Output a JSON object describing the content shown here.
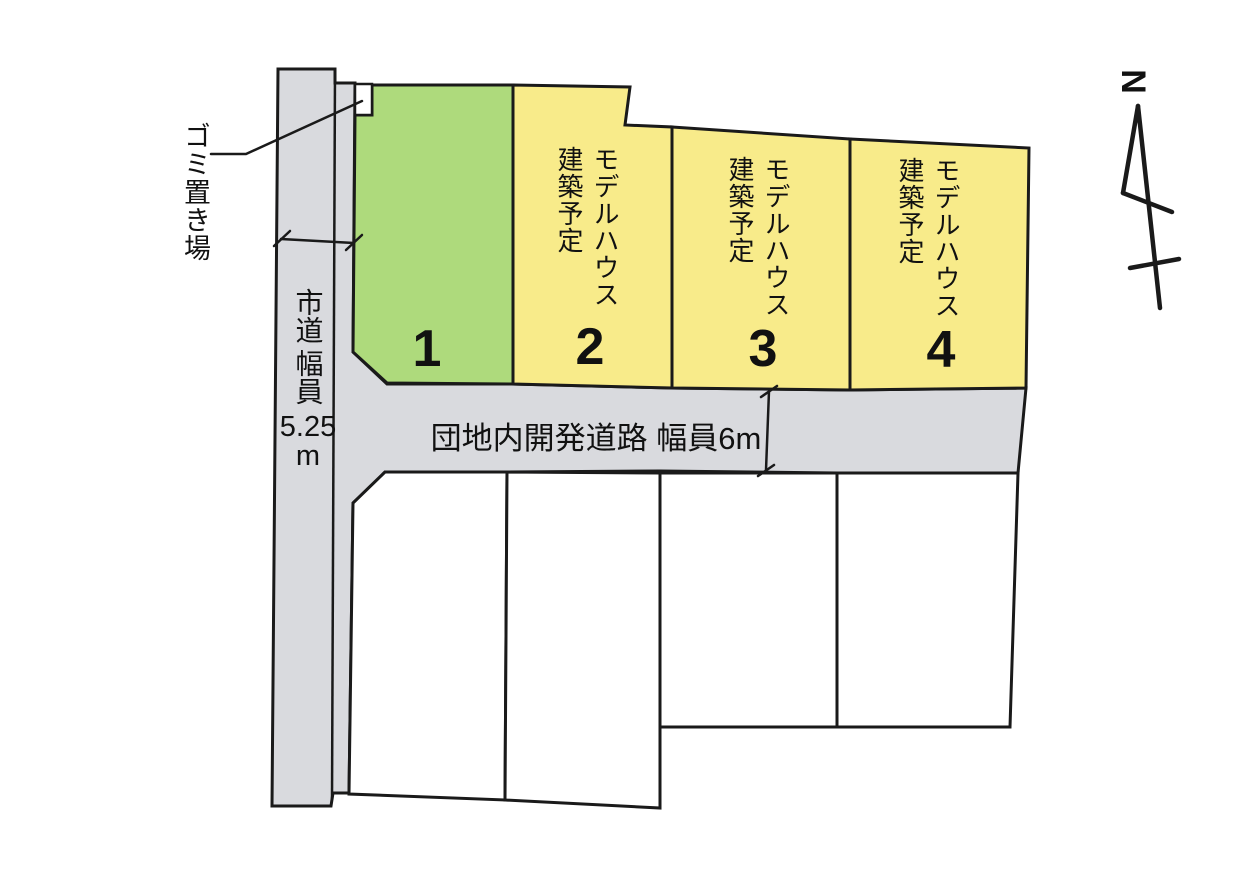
{
  "colors": {
    "lot_green": "#aeda7c",
    "lot_yellow": "#f8eb8a",
    "road_gray": "#d9dade",
    "outline": "#1a1a1a"
  },
  "north_label": "N",
  "garbage_area": {
    "label": "ゴミ置き場"
  },
  "city_road": {
    "name": "市道",
    "width_label": "幅員",
    "width_value": "5.25",
    "width_unit": "m"
  },
  "dev_road": {
    "label": "団地内開発道路 幅員6m"
  },
  "lots": [
    {
      "number": "1",
      "status": ""
    },
    {
      "number": "2",
      "status": "モデルハウス建築予定"
    },
    {
      "number": "3",
      "status": "モデルハウス建築予定"
    },
    {
      "number": "4",
      "status": "モデルハウス建築予定"
    }
  ]
}
